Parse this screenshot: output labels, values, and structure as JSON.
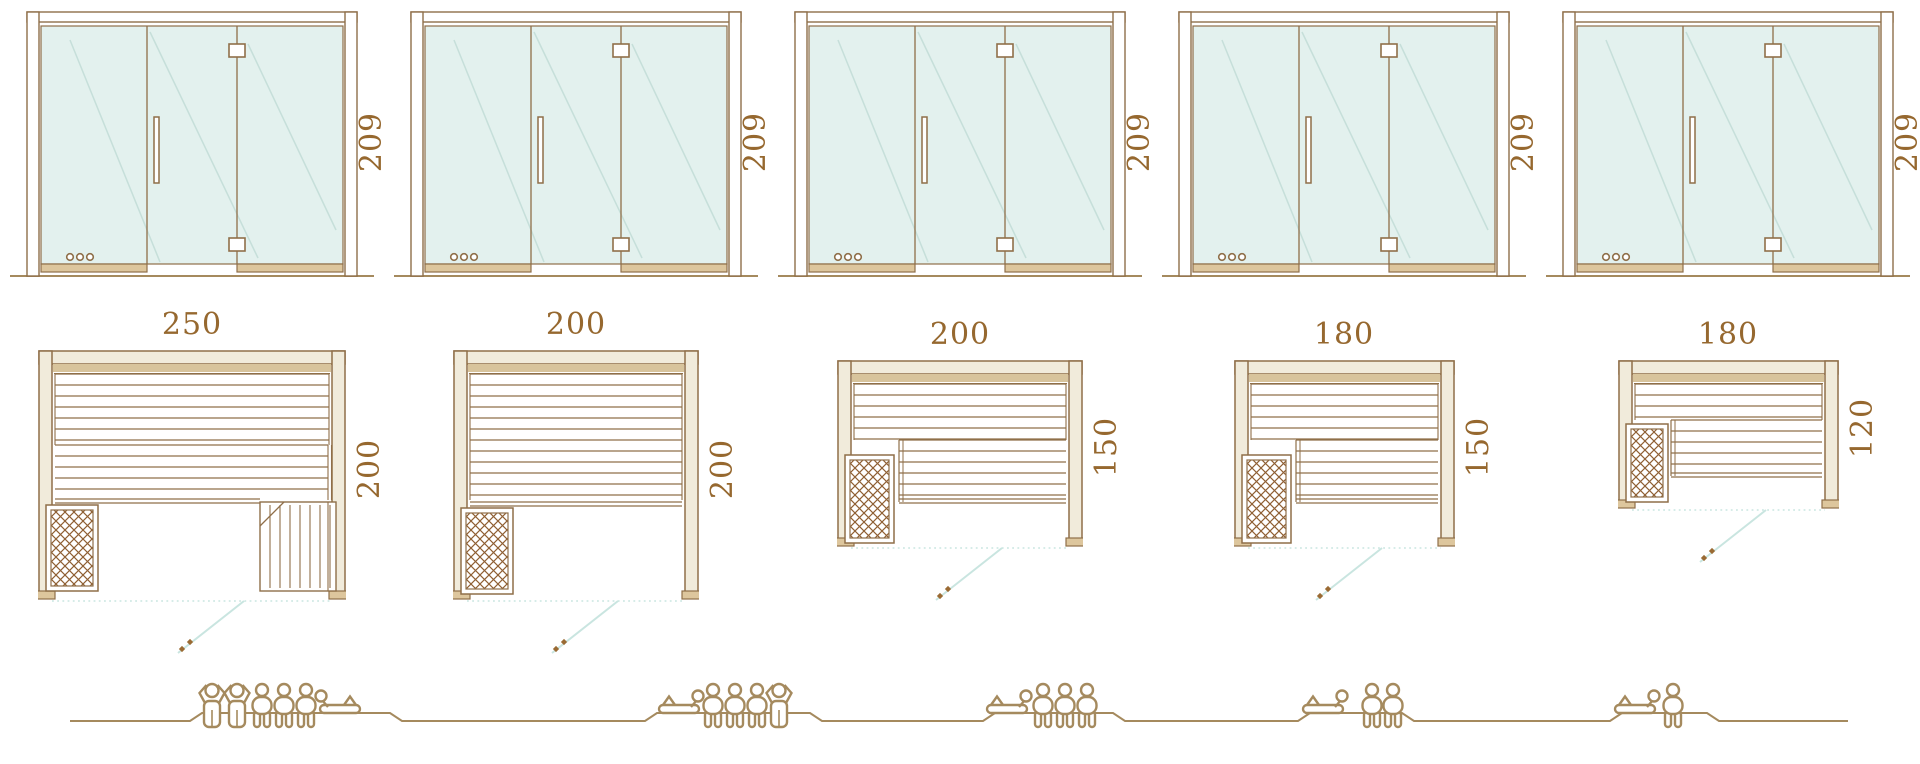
{
  "diagram": {
    "kind": "sauna-model-size-comparison",
    "rows": [
      "front-elevation",
      "floor-plan",
      "capacity-figures"
    ]
  },
  "colors": {
    "outline": "#8f6f49",
    "tan": "#ddc69d",
    "band": "#d8c49c",
    "cream": "#f1ebdb",
    "glass": "#e3f1ee",
    "reflection": "rgba(170,205,198,0.5)",
    "dimension_text": "#96682f",
    "people": "#a58a5e",
    "swing": "#c9e5e0",
    "heater_hatch": "#8f5f33",
    "handle_dot": "#9a6a33"
  },
  "icons": {
    "standing": "standing-person-icon",
    "sitting": "sitting-person-icon",
    "lying": "lying-person-icon",
    "heater": "heater-icon",
    "hinge": "door-hinge-icon",
    "handle": "door-handle-icon",
    "control_dots": "control-dots-icon"
  },
  "units": [
    {
      "name": "sauna-250x200",
      "door_height_label": "209",
      "width_label": "250",
      "depth_label": "200",
      "width_cm": 250,
      "depth_cm": 200,
      "elevation": {
        "glass_panels": 3,
        "hinges": 2,
        "handle": true,
        "control_dots": 3
      },
      "plan_features": {
        "back_bench": true,
        "heater": true,
        "corner_bench": true,
        "side_bench": false,
        "door_swing": true
      },
      "capacity": {
        "total": 6,
        "figures": [
          "standing",
          "standing",
          "sitting",
          "sitting",
          "sitting",
          "lying"
        ],
        "lying_head": "left"
      }
    },
    {
      "name": "sauna-200x200",
      "door_height_label": "209",
      "width_label": "200",
      "depth_label": "200",
      "width_cm": 200,
      "depth_cm": 200,
      "elevation": {
        "glass_panels": 3,
        "hinges": 2,
        "handle": true,
        "control_dots": 3
      },
      "plan_features": {
        "back_bench": true,
        "heater": true,
        "corner_bench": false,
        "side_bench": false,
        "door_swing": true
      },
      "capacity": {
        "total": 5,
        "figures": [
          "lying",
          "sitting",
          "sitting",
          "sitting",
          "standing"
        ],
        "lying_head": "right"
      }
    },
    {
      "name": "sauna-200x150",
      "door_height_label": "209",
      "width_label": "200",
      "depth_label": "150",
      "width_cm": 200,
      "depth_cm": 150,
      "elevation": {
        "glass_panels": 3,
        "hinges": 2,
        "handle": true,
        "control_dots": 3
      },
      "plan_features": {
        "back_bench": true,
        "heater": true,
        "corner_bench": false,
        "side_bench": true,
        "door_swing": true
      },
      "capacity": {
        "total": 4,
        "figures": [
          "lying",
          "sitting",
          "sitting",
          "sitting"
        ],
        "lying_head": "right"
      }
    },
    {
      "name": "sauna-180x150",
      "door_height_label": "209",
      "width_label": "180",
      "depth_label": "150",
      "width_cm": 180,
      "depth_cm": 150,
      "elevation": {
        "glass_panels": 3,
        "hinges": 2,
        "handle": true,
        "control_dots": 3
      },
      "plan_features": {
        "back_bench": true,
        "heater": true,
        "corner_bench": false,
        "side_bench": true,
        "door_swing": true
      },
      "capacity": {
        "total": 3,
        "figures": [
          "lying",
          "sitting",
          "sitting"
        ],
        "lying_head": "right"
      }
    },
    {
      "name": "sauna-180x120",
      "door_height_label": "209",
      "width_label": "180",
      "depth_label": "120",
      "width_cm": 180,
      "depth_cm": 120,
      "elevation": {
        "glass_panels": 3,
        "hinges": 2,
        "handle": true,
        "control_dots": 3
      },
      "plan_features": {
        "back_bench": true,
        "heater": true,
        "corner_bench": false,
        "side_bench": true,
        "door_swing": true
      },
      "capacity": {
        "total": 2,
        "figures": [
          "lying",
          "sitting"
        ],
        "lying_head": "right"
      }
    }
  ]
}
